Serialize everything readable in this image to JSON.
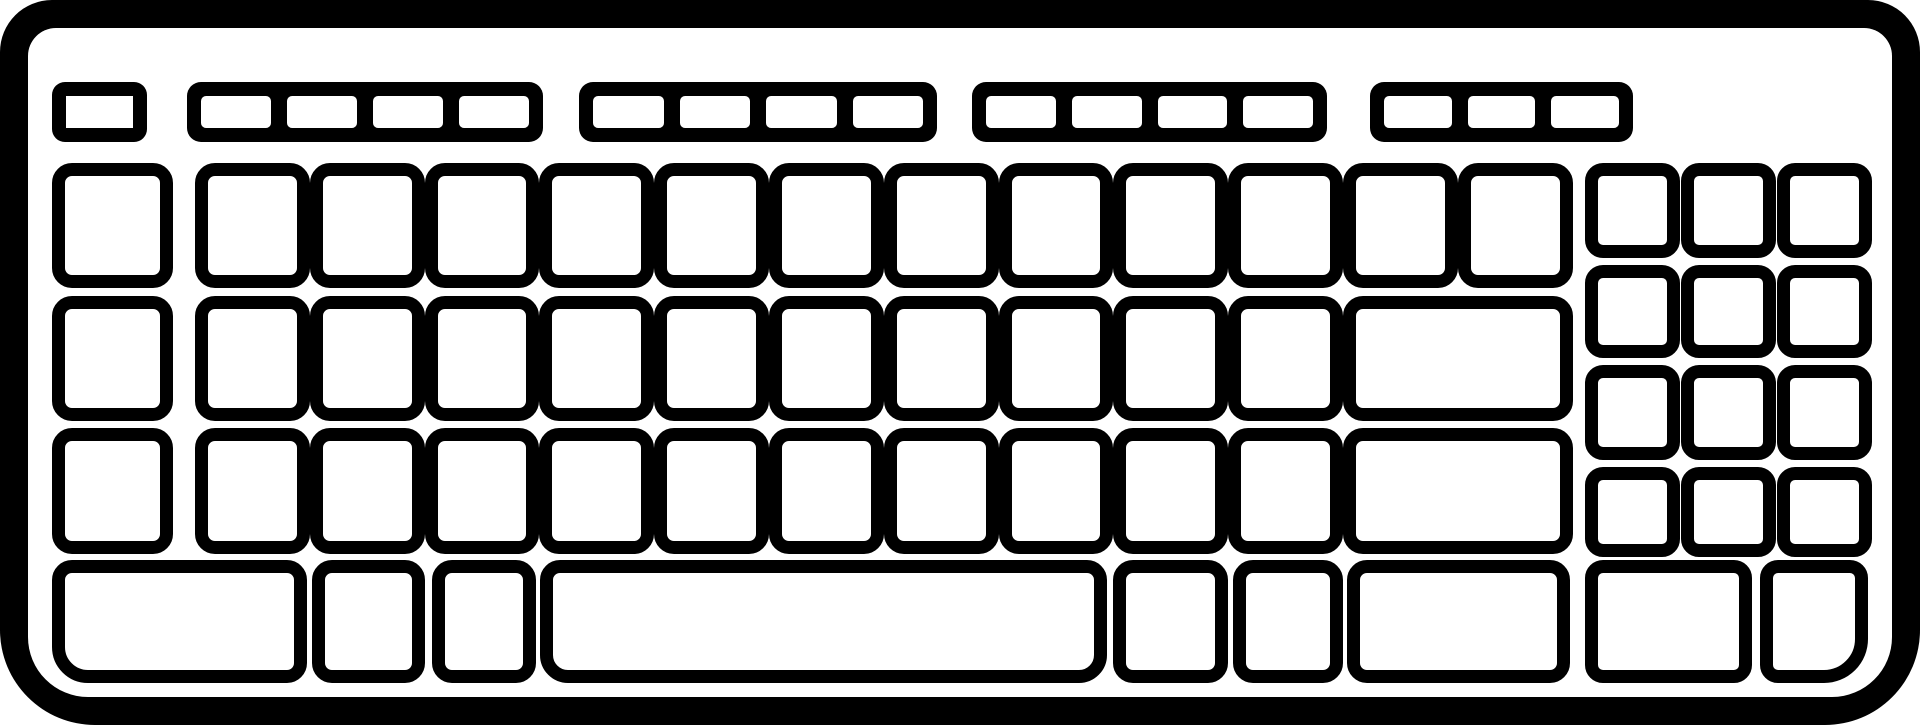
{
  "icon": {
    "name": "computer-keyboard-icon",
    "stroke_color": "#000000",
    "fill_color": "#ffffff"
  },
  "canvas": {
    "width": 1920,
    "height": 725
  },
  "body": {
    "x": 0,
    "y": 0,
    "w": 1920,
    "h": 725,
    "border_thickness": 28,
    "outer_radius": "52px 52px 95px 95px",
    "inner_radius": "28px 28px 60px 60px"
  },
  "function_row": {
    "esc_key": {
      "name": "esc-key",
      "x": 52,
      "y": 82,
      "w": 95,
      "h": 60
    },
    "groups": [
      {
        "name": "function-key-group-1",
        "x": 187,
        "y": 82,
        "w": 356,
        "h": 60,
        "cells": 4
      },
      {
        "name": "function-key-group-2",
        "x": 579,
        "y": 82,
        "w": 358,
        "h": 60,
        "cells": 4
      },
      {
        "name": "function-key-group-3",
        "x": 972,
        "y": 82,
        "w": 355,
        "h": 60,
        "cells": 4
      },
      {
        "name": "function-key-group-4",
        "x": 1370,
        "y": 82,
        "w": 263,
        "h": 60,
        "cells": 3
      }
    ]
  },
  "keys": [
    {
      "n": "left-column-key",
      "x": 52,
      "y": 163,
      "w": 121,
      "h": 125
    },
    {
      "n": "key",
      "x": 195,
      "y": 163,
      "w": 115,
      "h": 125
    },
    {
      "n": "key",
      "x": 310,
      "y": 163,
      "w": 115,
      "h": 125
    },
    {
      "n": "key",
      "x": 425,
      "y": 163,
      "w": 114,
      "h": 125
    },
    {
      "n": "key",
      "x": 539,
      "y": 163,
      "w": 115,
      "h": 125
    },
    {
      "n": "key",
      "x": 654,
      "y": 163,
      "w": 115,
      "h": 125
    },
    {
      "n": "key",
      "x": 769,
      "y": 163,
      "w": 115,
      "h": 125
    },
    {
      "n": "key",
      "x": 884,
      "y": 163,
      "w": 115,
      "h": 125
    },
    {
      "n": "key",
      "x": 999,
      "y": 163,
      "w": 114,
      "h": 125
    },
    {
      "n": "key",
      "x": 1113,
      "y": 163,
      "w": 115,
      "h": 125
    },
    {
      "n": "key",
      "x": 1228,
      "y": 163,
      "w": 115,
      "h": 125
    },
    {
      "n": "key",
      "x": 1343,
      "y": 163,
      "w": 115,
      "h": 125
    },
    {
      "n": "key",
      "x": 1458,
      "y": 163,
      "w": 115,
      "h": 125
    },
    {
      "n": "left-column-key",
      "x": 52,
      "y": 296,
      "w": 121,
      "h": 125
    },
    {
      "n": "key",
      "x": 195,
      "y": 296,
      "w": 115,
      "h": 125
    },
    {
      "n": "key",
      "x": 310,
      "y": 296,
      "w": 115,
      "h": 125
    },
    {
      "n": "key",
      "x": 425,
      "y": 296,
      "w": 114,
      "h": 125
    },
    {
      "n": "key",
      "x": 539,
      "y": 296,
      "w": 115,
      "h": 125
    },
    {
      "n": "key",
      "x": 654,
      "y": 296,
      "w": 115,
      "h": 125
    },
    {
      "n": "key",
      "x": 769,
      "y": 296,
      "w": 115,
      "h": 125
    },
    {
      "n": "key",
      "x": 884,
      "y": 296,
      "w": 115,
      "h": 125
    },
    {
      "n": "key",
      "x": 999,
      "y": 296,
      "w": 114,
      "h": 125
    },
    {
      "n": "key",
      "x": 1113,
      "y": 296,
      "w": 115,
      "h": 125
    },
    {
      "n": "key",
      "x": 1228,
      "y": 296,
      "w": 115,
      "h": 125
    },
    {
      "n": "enter-key",
      "x": 1343,
      "y": 296,
      "w": 230,
      "h": 125
    },
    {
      "n": "left-column-key",
      "x": 52,
      "y": 428,
      "w": 121,
      "h": 126
    },
    {
      "n": "key",
      "x": 195,
      "y": 428,
      "w": 115,
      "h": 126
    },
    {
      "n": "key",
      "x": 310,
      "y": 428,
      "w": 115,
      "h": 126
    },
    {
      "n": "key",
      "x": 425,
      "y": 428,
      "w": 114,
      "h": 126
    },
    {
      "n": "key",
      "x": 539,
      "y": 428,
      "w": 115,
      "h": 126
    },
    {
      "n": "key",
      "x": 654,
      "y": 428,
      "w": 115,
      "h": 126
    },
    {
      "n": "key",
      "x": 769,
      "y": 428,
      "w": 115,
      "h": 126
    },
    {
      "n": "key",
      "x": 884,
      "y": 428,
      "w": 115,
      "h": 126
    },
    {
      "n": "key",
      "x": 999,
      "y": 428,
      "w": 114,
      "h": 126
    },
    {
      "n": "key",
      "x": 1113,
      "y": 428,
      "w": 115,
      "h": 126
    },
    {
      "n": "key",
      "x": 1228,
      "y": 428,
      "w": 115,
      "h": 126
    },
    {
      "n": "right-shift-key",
      "x": 1343,
      "y": 428,
      "w": 230,
      "h": 126
    },
    {
      "n": "left-ctrl-key",
      "x": 52,
      "y": 560,
      "w": 255,
      "h": 123,
      "r": "20px 20px 20px 36px"
    },
    {
      "n": "modifier-key",
      "x": 312,
      "y": 560,
      "w": 113,
      "h": 123
    },
    {
      "n": "modifier-key",
      "x": 432,
      "y": 560,
      "w": 104,
      "h": 123
    },
    {
      "n": "spacebar",
      "x": 540,
      "y": 560,
      "w": 567,
      "h": 123,
      "r": "20px 20px 28px 28px"
    },
    {
      "n": "modifier-key",
      "x": 1113,
      "y": 560,
      "w": 115,
      "h": 123
    },
    {
      "n": "modifier-key",
      "x": 1233,
      "y": 560,
      "w": 110,
      "h": 123
    },
    {
      "n": "right-ctrl-key",
      "x": 1347,
      "y": 560,
      "w": 223,
      "h": 123
    },
    {
      "n": "numpad-key",
      "np": true,
      "x": 1585,
      "y": 163,
      "w": 95,
      "h": 95
    },
    {
      "n": "numpad-key",
      "np": true,
      "x": 1681,
      "y": 163,
      "w": 95,
      "h": 95
    },
    {
      "n": "numpad-key",
      "np": true,
      "x": 1777,
      "y": 163,
      "w": 95,
      "h": 95
    },
    {
      "n": "numpad-key",
      "np": true,
      "x": 1585,
      "y": 265,
      "w": 95,
      "h": 93
    },
    {
      "n": "numpad-key",
      "np": true,
      "x": 1681,
      "y": 265,
      "w": 95,
      "h": 93
    },
    {
      "n": "numpad-key",
      "np": true,
      "x": 1777,
      "y": 265,
      "w": 95,
      "h": 93
    },
    {
      "n": "numpad-key",
      "np": true,
      "x": 1585,
      "y": 365,
      "w": 95,
      "h": 95
    },
    {
      "n": "numpad-key",
      "np": true,
      "x": 1681,
      "y": 365,
      "w": 95,
      "h": 95
    },
    {
      "n": "numpad-key",
      "np": true,
      "x": 1777,
      "y": 365,
      "w": 95,
      "h": 95
    },
    {
      "n": "numpad-key",
      "np": true,
      "x": 1585,
      "y": 467,
      "w": 95,
      "h": 90
    },
    {
      "n": "numpad-key",
      "np": true,
      "x": 1681,
      "y": 467,
      "w": 95,
      "h": 90
    },
    {
      "n": "numpad-key",
      "np": true,
      "x": 1777,
      "y": 467,
      "w": 95,
      "h": 90
    },
    {
      "n": "numpad-zero-key",
      "np": true,
      "x": 1585,
      "y": 560,
      "w": 167,
      "h": 123
    },
    {
      "n": "numpad-dot-key",
      "np": true,
      "x": 1760,
      "y": 560,
      "w": 108,
      "h": 123,
      "r": "18px 18px 44px 18px"
    }
  ]
}
